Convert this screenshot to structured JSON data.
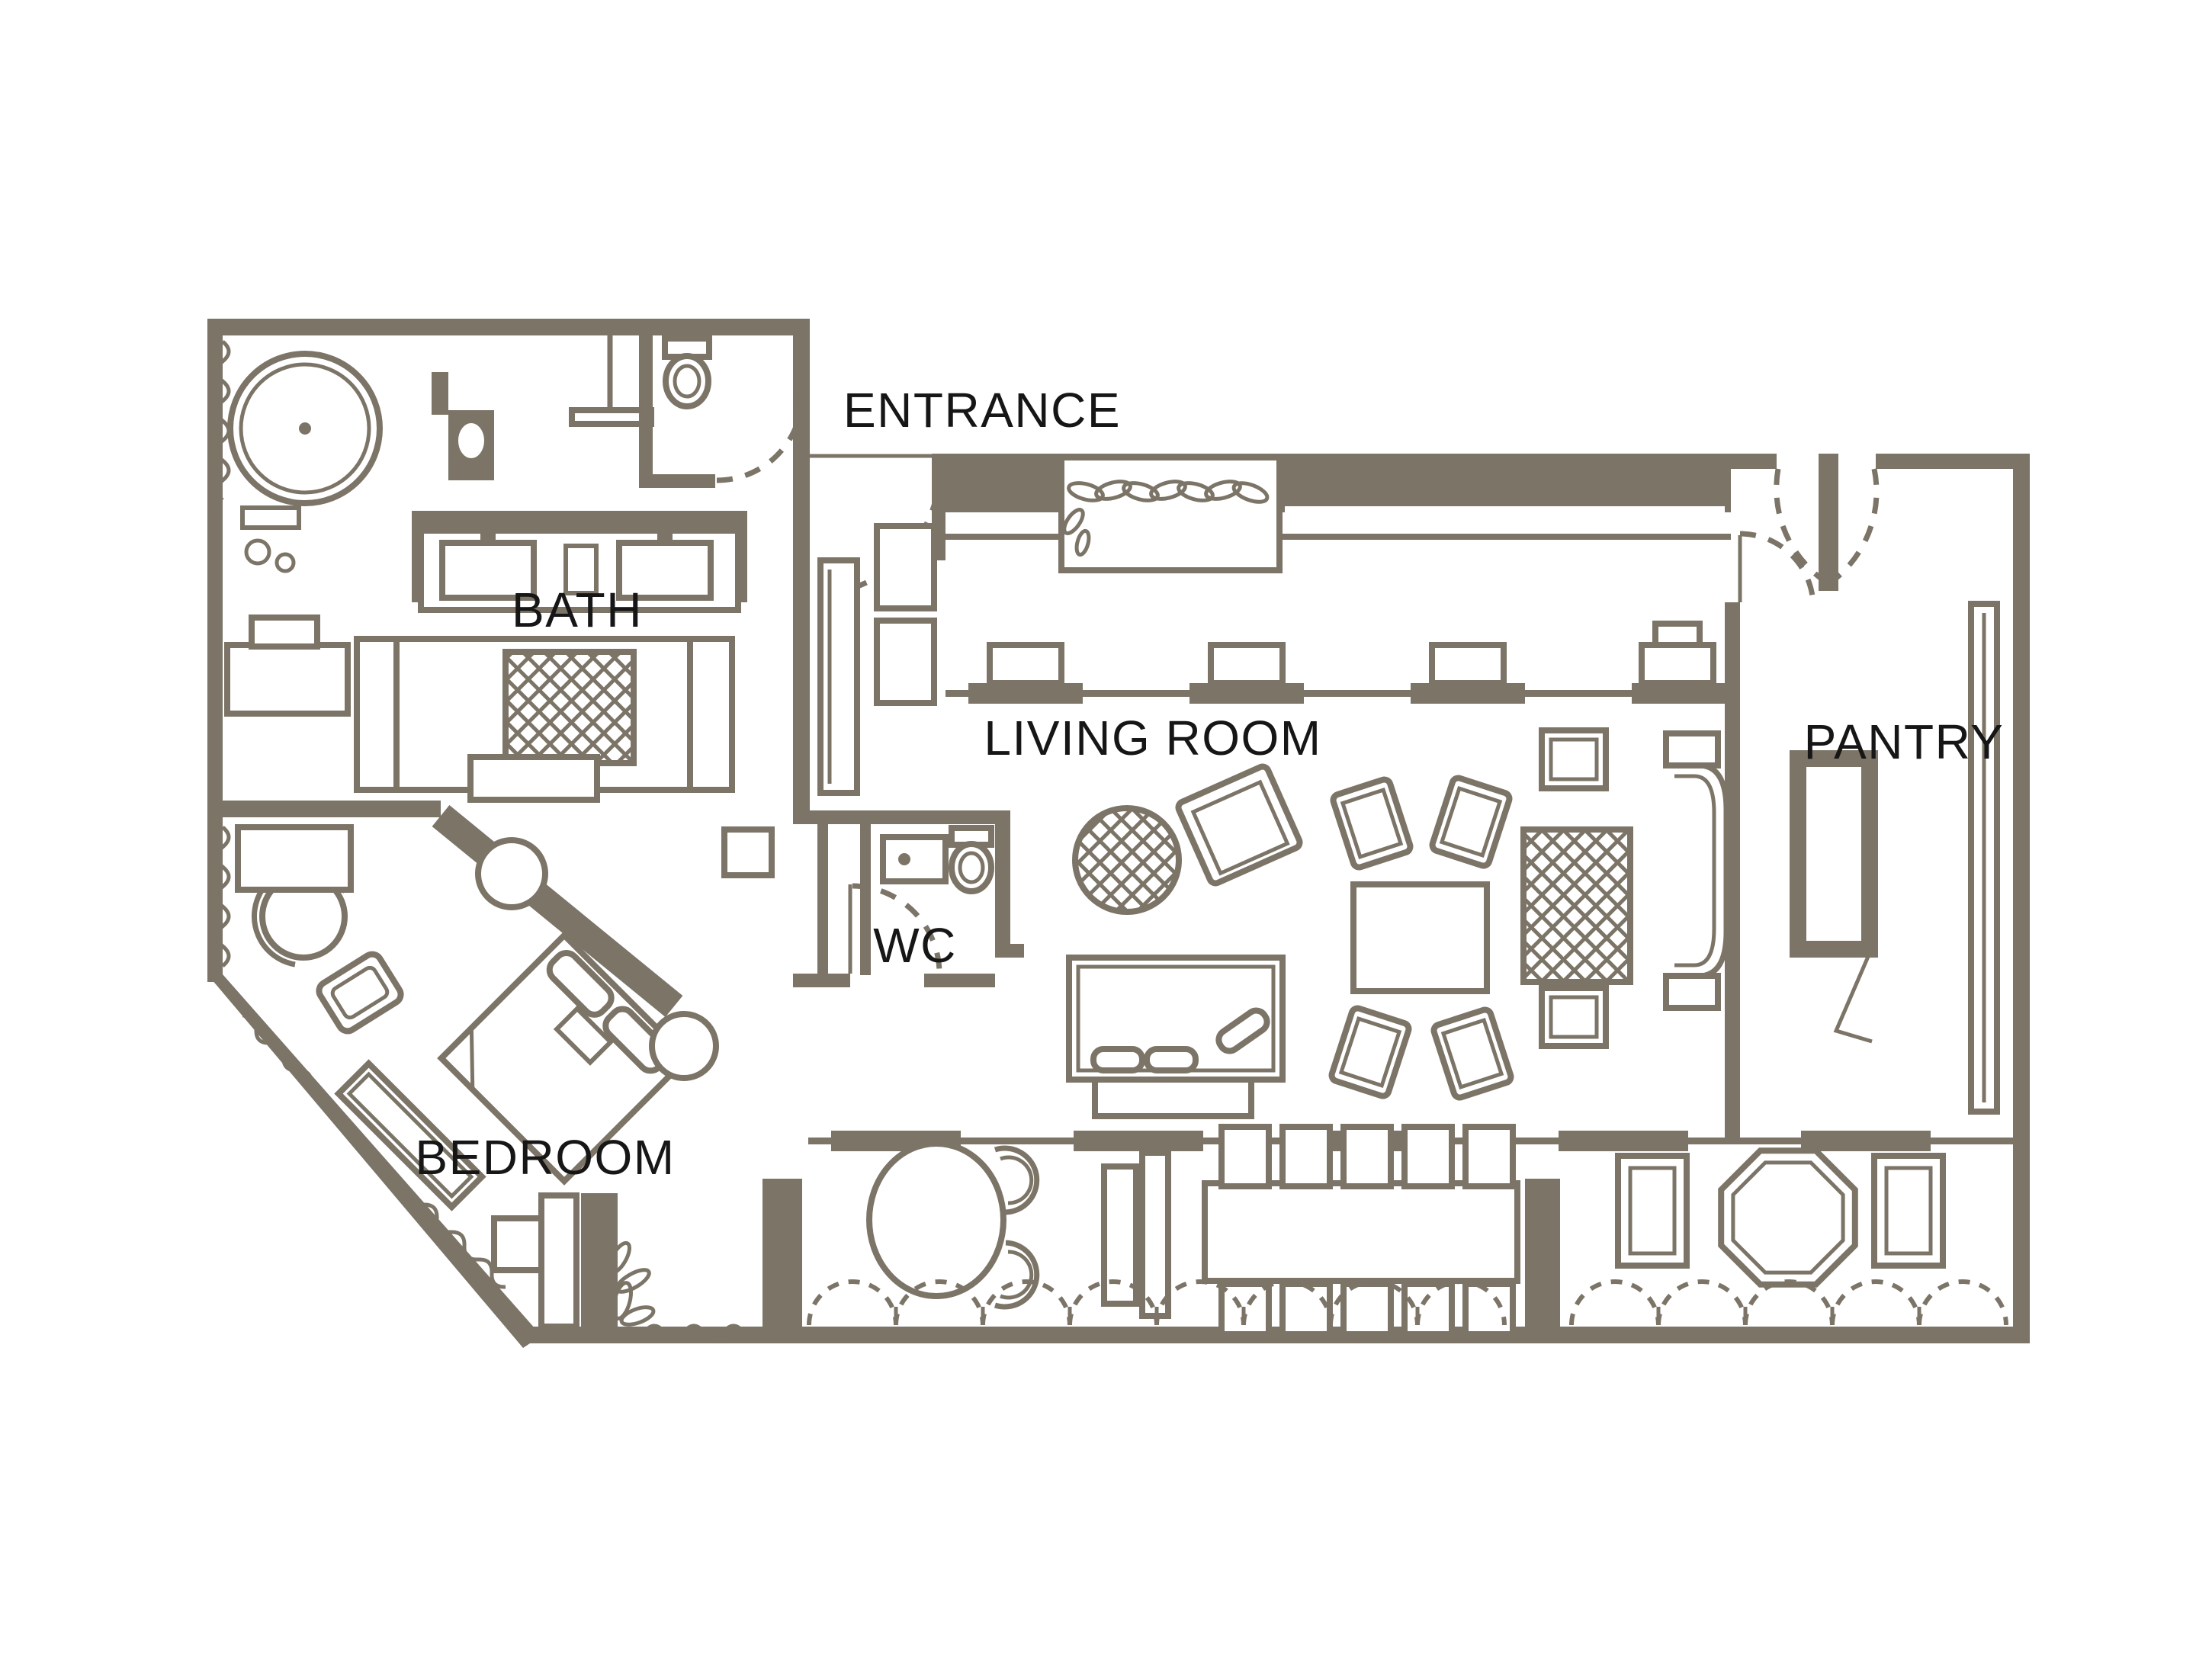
{
  "rooms": [
    {
      "id": "entrance",
      "label": "ENTRANCE"
    },
    {
      "id": "bath",
      "label": "BATH"
    },
    {
      "id": "living-room",
      "label": "LIVING ROOM"
    },
    {
      "id": "pantry",
      "label": "PANTRY"
    },
    {
      "id": "wc",
      "label": "WC"
    },
    {
      "id": "bedroom",
      "label": "BEDROOM"
    }
  ],
  "colors": {
    "wall": "#7b7467",
    "label": "#161616",
    "background": "#ffffff"
  },
  "plan_type": "suite floor plan"
}
